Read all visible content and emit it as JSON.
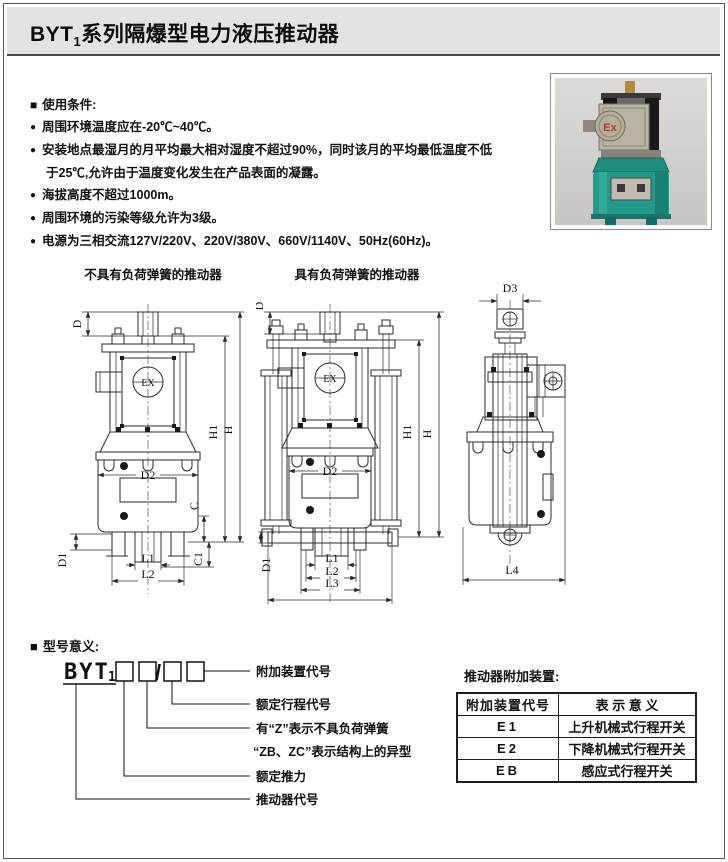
{
  "header": {
    "title_prefix": "BYT",
    "title_sub": "1",
    "title_suffix": "系列隔爆型电力液压推动器"
  },
  "conditions": {
    "marker": "■",
    "bullet": "●",
    "heading": "使用条件:",
    "items": [
      "周围环境温度应在-20℃~40℃。",
      "安装地点最湿月的月平均最大相对湿度不超过90%，同时该月的平均最低温度不低",
      "于25℃,允许由于温度变化发生在产品表面的凝露。",
      "海拔高度不超过1000m。",
      "周围环境的污染等级允许为3级。",
      "电源为三相交流127V/220V、220V/380V、660V/1140V、50Hz(60Hz)。"
    ]
  },
  "photo": {
    "ex_label": "Ex"
  },
  "diagrams": {
    "left_title": "不具有负荷弹簧的推动器",
    "right_title": "具有负荷弹簧的推动器",
    "ex_label": "EX",
    "labels": {
      "D": "D",
      "D1": "D1",
      "D2": "D2",
      "D3": "D3",
      "H": "H",
      "H1": "H1",
      "C": "C",
      "C1": "C1",
      "L1": "L1",
      "L2": "L2",
      "L3": "L3",
      "L4": "L4"
    }
  },
  "model": {
    "marker": "■",
    "heading": "型号意义:",
    "code_prefix": "BYT",
    "code_sub": "1",
    "slash": "/",
    "labels": {
      "l1": "附加装置代号",
      "l2": "额定行程代号",
      "l3": "有“Z”表示不具负荷弹簧",
      "l4": "“ZB、ZC”表示结构上的异型",
      "l5": "额定推力",
      "l6": "推动器代号"
    }
  },
  "accessories": {
    "title": "推动器附加装置:",
    "headers": [
      "附加装置代号",
      "表 示 意 义"
    ],
    "rows": [
      {
        "code": "E1",
        "meaning": "上升机械式行程开关"
      },
      {
        "code": "E2",
        "meaning": "下降机械式行程开关"
      },
      {
        "code": "EB",
        "meaning": "感应式行程开关"
      }
    ]
  },
  "colors": {
    "header_bg": "#e3e3e3",
    "line_color": "#2b2b2b",
    "photo_teal": "#239a8c",
    "ex_red": "#c43522"
  }
}
